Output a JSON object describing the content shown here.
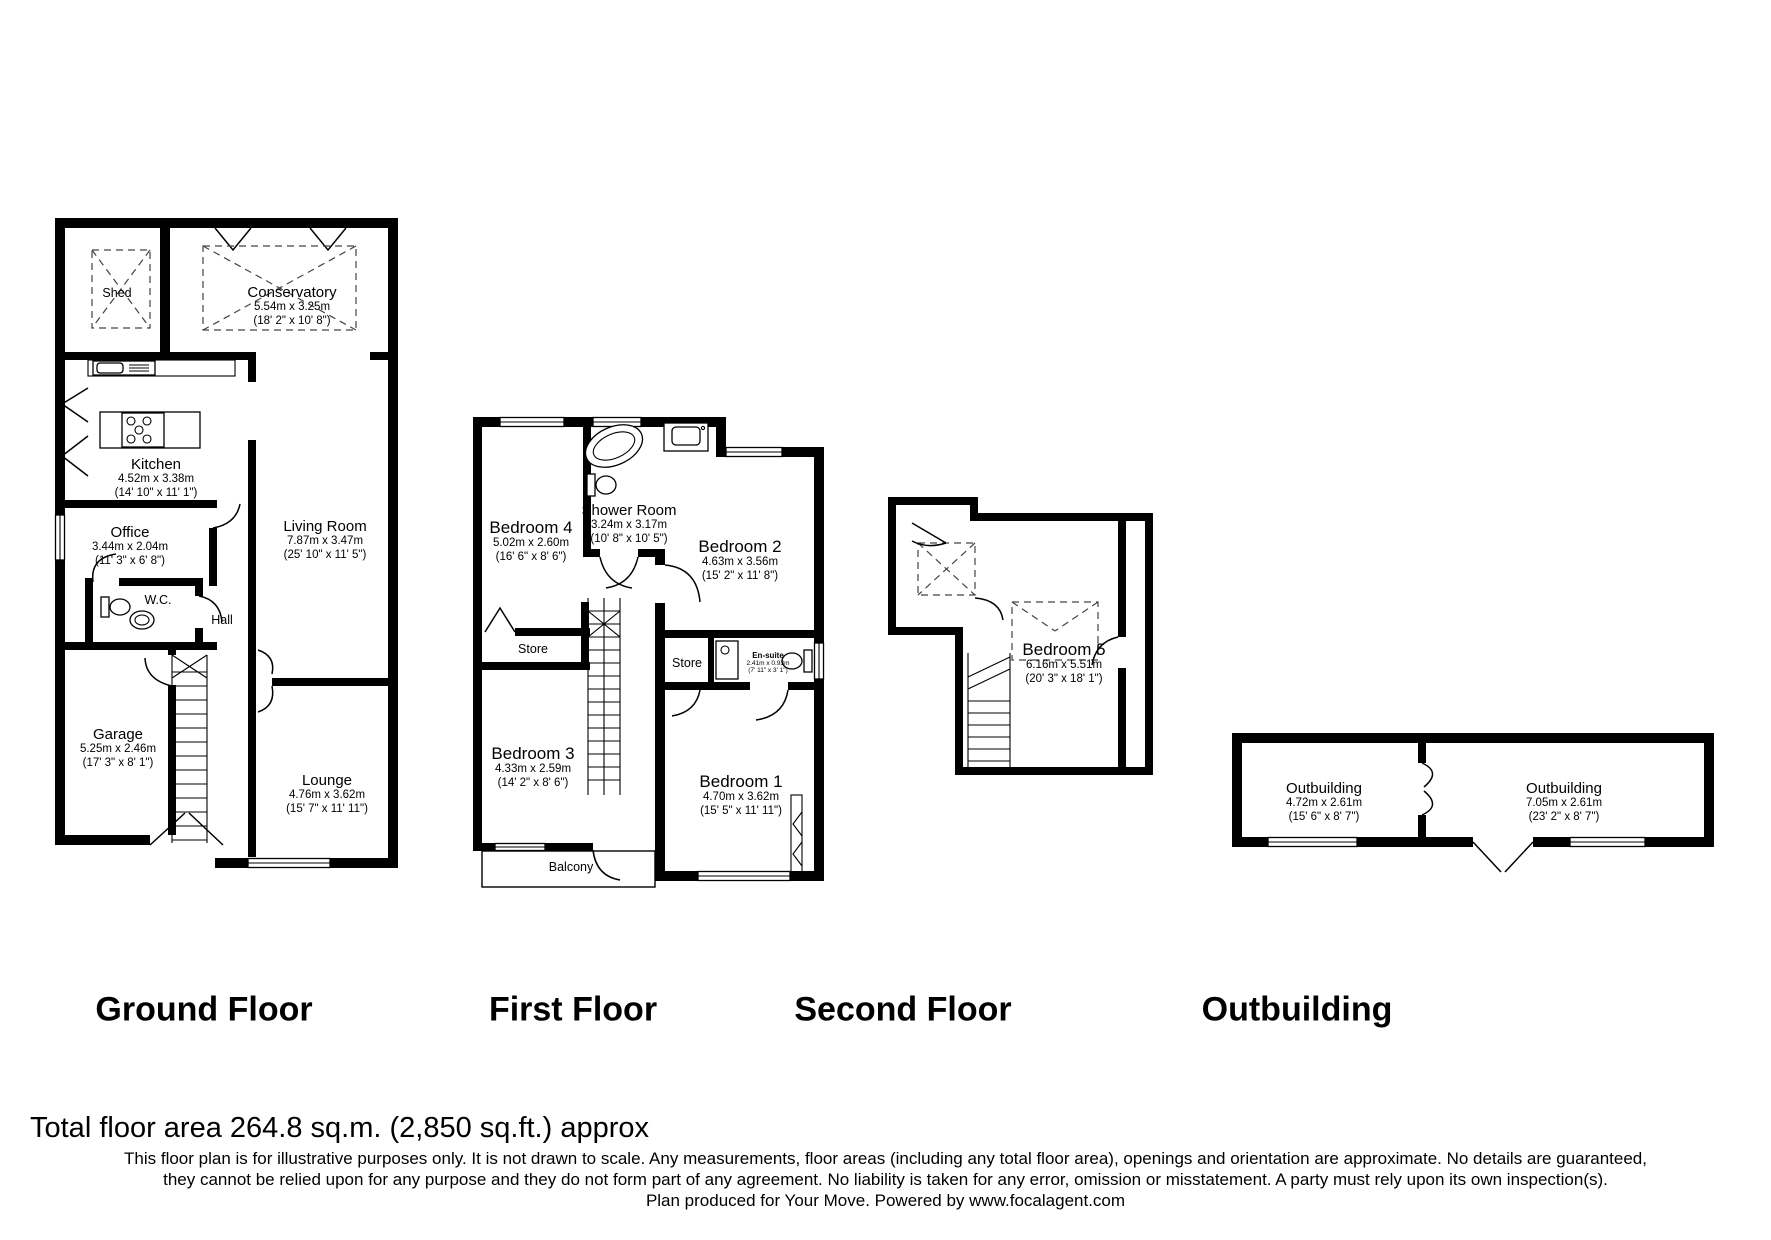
{
  "colors": {
    "ink": "#000000",
    "background": "#ffffff"
  },
  "floors": {
    "ground": {
      "heading": "Ground Floor",
      "rooms": {
        "shed": {
          "name": "Shed"
        },
        "conservatory": {
          "name": "Conservatory",
          "m": "5.54m x 3.25m",
          "ft": "(18' 2\" x 10' 8\")"
        },
        "kitchen": {
          "name": "Kitchen",
          "m": "4.52m x 3.38m",
          "ft": "(14' 10\" x 11' 1\")"
        },
        "office": {
          "name": "Office",
          "m": "3.44m x 2.04m",
          "ft": "(11' 3\" x 6' 8\")"
        },
        "wc": {
          "name": "W.C."
        },
        "hall": {
          "name": "Hall"
        },
        "living": {
          "name": "Living Room",
          "m": "7.87m x 3.47m",
          "ft": "(25' 10\" x 11' 5\")"
        },
        "garage": {
          "name": "Garage",
          "m": "5.25m x 2.46m",
          "ft": "(17' 3\" x 8' 1\")"
        },
        "lounge": {
          "name": "Lounge",
          "m": "4.76m x 3.62m",
          "ft": "(15' 7\" x 11' 11\")"
        }
      }
    },
    "first": {
      "heading": "First Floor",
      "rooms": {
        "bedroom4": {
          "name": "Bedroom 4",
          "m": "5.02m x 2.60m",
          "ft": "(16' 6\" x 8' 6\")"
        },
        "shower": {
          "name": "Shower Room",
          "m": "3.24m x 3.17m",
          "ft": "(10' 8\" x 10' 5\")"
        },
        "bedroom2": {
          "name": "Bedroom 2",
          "m": "4.63m x 3.56m",
          "ft": "(15' 2\" x 11' 8\")"
        },
        "store1": {
          "name": "Store"
        },
        "store2": {
          "name": "Store"
        },
        "ensuite": {
          "name": "En-suite",
          "m": "2.41m x 0.93m",
          "ft": "(7' 11\" x 3' 1\")"
        },
        "bedroom3": {
          "name": "Bedroom 3",
          "m": "4.33m x 2.59m",
          "ft": "(14' 2\" x 8' 6\")"
        },
        "bedroom1": {
          "name": "Bedroom 1",
          "m": "4.70m x 3.62m",
          "ft": "(15' 5\" x 11' 11\")"
        },
        "balcony": {
          "name": "Balcony"
        }
      }
    },
    "second": {
      "heading": "Second Floor",
      "rooms": {
        "bedroom5": {
          "name": "Bedroom 5",
          "m": "6.16m x 5.51m",
          "ft": "(20' 3\" x 18' 1\")"
        }
      }
    },
    "outbuilding": {
      "heading": "Outbuilding",
      "rooms": {
        "out1": {
          "name": "Outbuilding",
          "m": "4.72m x 2.61m",
          "ft": "(15' 6\" x 8' 7\")"
        },
        "out2": {
          "name": "Outbuilding",
          "m": "7.05m x 2.61m",
          "ft": "(23' 2\" x 8' 7\")"
        }
      }
    }
  },
  "footer": {
    "total": "Total floor area 264.8 sq.m. (2,850 sq.ft.) approx",
    "disclaimer1": "This floor plan is for illustrative purposes only. It is not drawn to scale. Any measurements, floor areas (including any total floor area), openings and orientation are approximate. No details are guaranteed,",
    "disclaimer2": "they cannot be relied upon for any purpose and they do not form part of any agreement. No liability is taken for any error, omission or misstatement. A party must rely upon its own inspection(s).",
    "disclaimer3": "Plan produced for Your Move. Powered by www.focalagent.com"
  }
}
